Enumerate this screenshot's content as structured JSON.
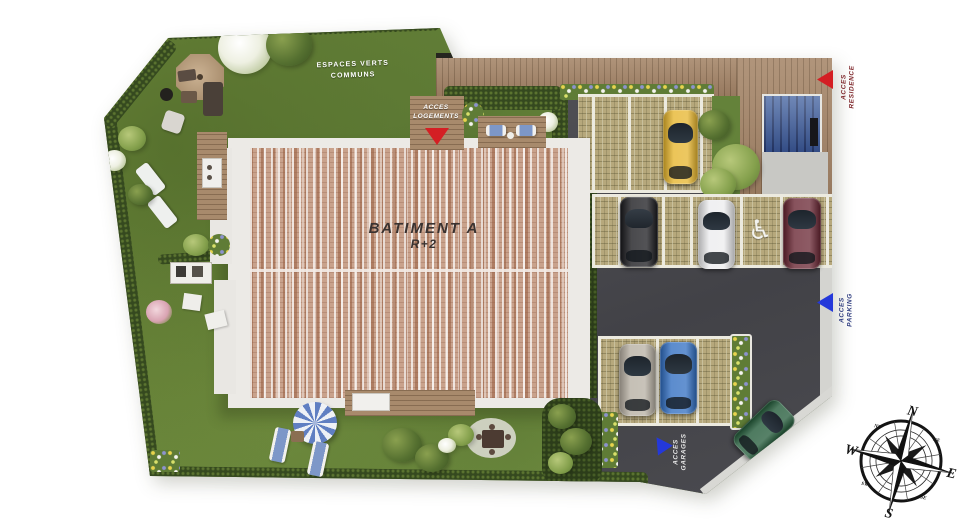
{
  "title": "Plan masse residence - Batiment A",
  "building": {
    "name": "BATIMENT A",
    "level": "R+2"
  },
  "labels": {
    "green_spaces": {
      "line1": "ESPACES VERTS",
      "line2": "COMMUNS"
    },
    "access_logements": {
      "line1": "ACCES",
      "line2": "LOGEMENTS"
    },
    "access_residence": {
      "line1": "ACCES",
      "line2": "RESIDENCE"
    },
    "access_parking": {
      "line1": "ACCES",
      "line2": "PARKING"
    },
    "access_garages": {
      "line1": "ACCES",
      "line2": "GARAGES"
    }
  },
  "compass": {
    "n": "N",
    "e": "E",
    "s": "S",
    "w": "W",
    "ne": "NE",
    "nw": "NW",
    "se": "SE",
    "sw": "SW"
  },
  "symbols": {
    "handicap": "♿"
  },
  "colors": {
    "arrow_red": "#d41f24",
    "arrow_blue": "#2438da",
    "grass": "#6b8a3e",
    "roof_tile": "#c9a28c",
    "asphalt": "#47474b",
    "paver": "#b6a87c",
    "wood_deck": "#a3856a",
    "label_residence_text": "#7d2428",
    "label_parking_text": "#2c3a7e",
    "label_garages_text": "#e8e8e8",
    "cars": {
      "yellow": "#e6b42a",
      "black": "#17171b",
      "white": "#ececee",
      "dark_red": "#66222f",
      "silver": "#b5aea1",
      "blue": "#2e6cc0",
      "green": "#1d5634"
    }
  }
}
